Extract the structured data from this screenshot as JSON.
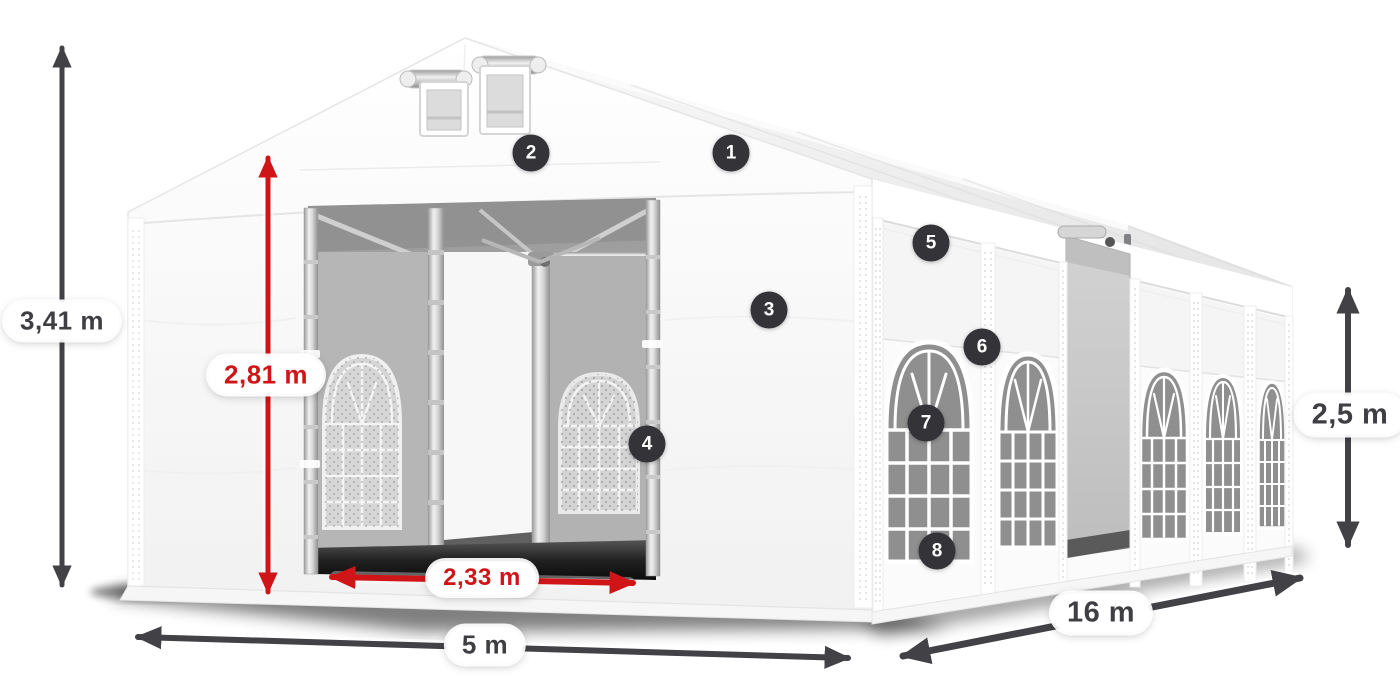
{
  "diagram": {
    "dimensions": {
      "total_height": {
        "label": "3,41 m"
      },
      "entrance_height": {
        "label": "2,81 m"
      },
      "entrance_width": {
        "label": "2,33 m"
      },
      "front_width": {
        "label": "5 m"
      },
      "side_length": {
        "label": "16 m"
      },
      "wall_height": {
        "label": "2,5 m"
      }
    },
    "markers": [
      {
        "number": "1"
      },
      {
        "number": "2"
      },
      {
        "number": "3"
      },
      {
        "number": "4"
      },
      {
        "number": "5"
      },
      {
        "number": "6"
      },
      {
        "number": "7"
      },
      {
        "number": "8"
      }
    ],
    "colors": {
      "dimension_dark": "#414146",
      "dimension_red": "#cf1518",
      "marker_background": "#333338",
      "marker_text": "#ffffff"
    }
  }
}
